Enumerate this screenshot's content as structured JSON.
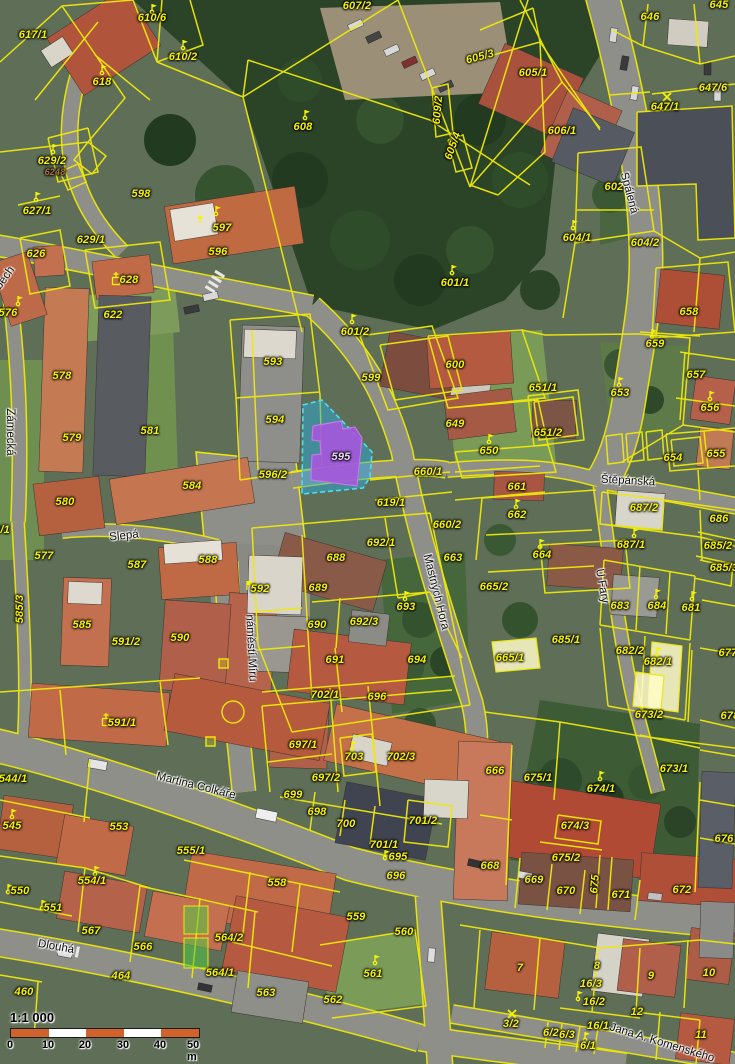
{
  "map": {
    "type": "cadastral-aerial-overlay",
    "highlight_parcel": {
      "number": "595",
      "parcel_fill": "rgba(43,170,220,0.5)",
      "parcel_stroke": "#49e0f2",
      "building_fill": "#a855dd",
      "building_stroke": "#c07ae8"
    },
    "line_color": "#eee90a",
    "scale": {
      "ratio_label": "1:1 000",
      "unit_labels": [
        "0",
        "10",
        "20",
        "30",
        "40",
        "50 m"
      ],
      "tick_positions": [
        0,
        38,
        75,
        113,
        150,
        188
      ],
      "bar_color_a": "#d2622b",
      "bar_color_b": "#ffffff"
    },
    "street_labels": [
      {
        "t": "Spálená",
        "x": 629,
        "y": 193,
        "r": 75
      },
      {
        "t": "Štěpánská",
        "x": 628,
        "y": 481,
        "r": 3
      },
      {
        "t": "Slepá",
        "x": 124,
        "y": 536,
        "r": -6
      },
      {
        "t": "Zámecká",
        "x": 10,
        "y": 432,
        "r": 90
      },
      {
        "t": "náměstí Míru",
        "x": 251,
        "y": 648,
        "r": 87
      },
      {
        "t": "U Fary",
        "x": 602,
        "y": 586,
        "r": 80
      },
      {
        "t": "Mastných Hora",
        "x": 436,
        "y": 592,
        "r": 76
      },
      {
        "t": "Martina Colkáře",
        "x": 196,
        "y": 786,
        "r": 14
      },
      {
        "t": "Dlouhá",
        "x": 56,
        "y": 947,
        "r": 10
      },
      {
        "t": "Jana A. Komenského",
        "x": 662,
        "y": 1043,
        "r": 17
      },
      {
        "t": "bech",
        "x": 5,
        "y": 278,
        "r": -55
      }
    ],
    "parcel_labels": [
      {
        "t": "617/1",
        "x": 33,
        "y": 35
      },
      {
        "t": "610/6",
        "x": 152,
        "y": 18
      },
      {
        "t": "610/2",
        "x": 183,
        "y": 57
      },
      {
        "t": "618",
        "x": 102,
        "y": 82
      },
      {
        "t": "608",
        "x": 303,
        "y": 127
      },
      {
        "t": "607/2",
        "x": 357,
        "y": 6
      },
      {
        "t": "629/2",
        "x": 52,
        "y": 161
      },
      {
        "t": "6248",
        "x": 55,
        "y": 172,
        "cls": "minor"
      },
      {
        "t": "598",
        "x": 141,
        "y": 194
      },
      {
        "t": "596",
        "x": 218,
        "y": 252
      },
      {
        "t": "597",
        "x": 222,
        "y": 228
      },
      {
        "t": "627/1",
        "x": 37,
        "y": 211
      },
      {
        "t": "626",
        "x": 36,
        "y": 254
      },
      {
        "t": "629/1",
        "x": 91,
        "y": 240
      },
      {
        "t": "628",
        "x": 129,
        "y": 280
      },
      {
        "t": "622",
        "x": 113,
        "y": 315
      },
      {
        "t": "576",
        "x": 8,
        "y": 313
      },
      {
        "t": "578",
        "x": 62,
        "y": 376
      },
      {
        "t": "579",
        "x": 72,
        "y": 438
      },
      {
        "t": "581",
        "x": 150,
        "y": 431
      },
      {
        "t": "580",
        "x": 65,
        "y": 502
      },
      {
        "t": "584",
        "x": 192,
        "y": 486
      },
      {
        "t": "8/1",
        "x": 2,
        "y": 530
      },
      {
        "t": "577",
        "x": 44,
        "y": 556
      },
      {
        "t": "587",
        "x": 137,
        "y": 565
      },
      {
        "t": "588",
        "x": 208,
        "y": 560
      },
      {
        "t": "585/3",
        "x": 20,
        "y": 609,
        "r": -90
      },
      {
        "t": "585",
        "x": 82,
        "y": 625
      },
      {
        "t": "591/2",
        "x": 126,
        "y": 642
      },
      {
        "t": "590",
        "x": 180,
        "y": 638
      },
      {
        "t": "593",
        "x": 273,
        "y": 362
      },
      {
        "t": "594",
        "x": 275,
        "y": 420
      },
      {
        "t": "595",
        "x": 341,
        "y": 457,
        "cls": "hl"
      },
      {
        "t": "596/2",
        "x": 273,
        "y": 475
      },
      {
        "t": "599",
        "x": 371,
        "y": 378
      },
      {
        "t": "601/2",
        "x": 355,
        "y": 332
      },
      {
        "t": "601/1",
        "x": 455,
        "y": 283
      },
      {
        "t": "600",
        "x": 455,
        "y": 365
      },
      {
        "t": "605/3",
        "x": 480,
        "y": 57,
        "r": -15
      },
      {
        "t": "605/1",
        "x": 533,
        "y": 73
      },
      {
        "t": "609/2",
        "x": 438,
        "y": 110,
        "r": -85
      },
      {
        "t": "605/4",
        "x": 453,
        "y": 146,
        "r": -70
      },
      {
        "t": "606/1",
        "x": 562,
        "y": 131
      },
      {
        "t": "602",
        "x": 614,
        "y": 187
      },
      {
        "t": "604/1",
        "x": 577,
        "y": 238
      },
      {
        "t": "604/2",
        "x": 645,
        "y": 243
      },
      {
        "t": "646",
        "x": 650,
        "y": 17
      },
      {
        "t": "645",
        "x": 719,
        "y": 5
      },
      {
        "t": "647/6",
        "x": 713,
        "y": 88
      },
      {
        "t": "647/1",
        "x": 665,
        "y": 107
      },
      {
        "t": "658",
        "x": 689,
        "y": 312
      },
      {
        "t": "659",
        "x": 655,
        "y": 344
      },
      {
        "t": "653",
        "x": 620,
        "y": 393
      },
      {
        "t": "651/1",
        "x": 543,
        "y": 388
      },
      {
        "t": "651/2",
        "x": 548,
        "y": 433
      },
      {
        "t": "649",
        "x": 455,
        "y": 424
      },
      {
        "t": "650",
        "x": 489,
        "y": 451
      },
      {
        "t": "657",
        "x": 696,
        "y": 375
      },
      {
        "t": "656",
        "x": 710,
        "y": 408
      },
      {
        "t": "655",
        "x": 716,
        "y": 454
      },
      {
        "t": "654",
        "x": 673,
        "y": 458
      },
      {
        "t": "660/1",
        "x": 428,
        "y": 472
      },
      {
        "t": "619/1",
        "x": 391,
        "y": 503
      },
      {
        "t": "661",
        "x": 517,
        "y": 487
      },
      {
        "t": "662",
        "x": 517,
        "y": 515
      },
      {
        "t": "663",
        "x": 453,
        "y": 558
      },
      {
        "t": "664",
        "x": 542,
        "y": 555
      },
      {
        "t": "665/2",
        "x": 494,
        "y": 587
      },
      {
        "t": "665/1",
        "x": 510,
        "y": 658
      },
      {
        "t": "685/1",
        "x": 566,
        "y": 640
      },
      {
        "t": "687/2",
        "x": 644,
        "y": 508
      },
      {
        "t": "687/1",
        "x": 631,
        "y": 545
      },
      {
        "t": "686",
        "x": 719,
        "y": 519
      },
      {
        "t": "685/2",
        "x": 718,
        "y": 546
      },
      {
        "t": "685/3",
        "x": 724,
        "y": 568
      },
      {
        "t": "683",
        "x": 620,
        "y": 606
      },
      {
        "t": "684",
        "x": 657,
        "y": 606
      },
      {
        "t": "681",
        "x": 691,
        "y": 608
      },
      {
        "t": "682/2",
        "x": 630,
        "y": 651
      },
      {
        "t": "682/1",
        "x": 658,
        "y": 662
      },
      {
        "t": "673/2",
        "x": 649,
        "y": 715
      },
      {
        "t": "677",
        "x": 728,
        "y": 653
      },
      {
        "t": "678",
        "x": 730,
        "y": 716
      },
      {
        "t": "688",
        "x": 336,
        "y": 558
      },
      {
        "t": "689",
        "x": 318,
        "y": 588
      },
      {
        "t": "690",
        "x": 317,
        "y": 625
      },
      {
        "t": "691",
        "x": 335,
        "y": 660
      },
      {
        "t": "692/1",
        "x": 381,
        "y": 543
      },
      {
        "t": "692/3",
        "x": 364,
        "y": 622
      },
      {
        "t": "693",
        "x": 406,
        "y": 607
      },
      {
        "t": "694",
        "x": 417,
        "y": 660
      },
      {
        "t": "695",
        "x": 398,
        "y": 857
      },
      {
        "t": "696",
        "x": 377,
        "y": 697
      },
      {
        "t": "696",
        "x": 396,
        "y": 876
      },
      {
        "t": "702/1",
        "x": 325,
        "y": 695
      },
      {
        "t": "697/1",
        "x": 303,
        "y": 745
      },
      {
        "t": "703",
        "x": 354,
        "y": 757
      },
      {
        "t": "702/3",
        "x": 401,
        "y": 757
      },
      {
        "t": "697/2",
        "x": 326,
        "y": 778
      },
      {
        "t": "699",
        "x": 293,
        "y": 795
      },
      {
        "t": "698",
        "x": 317,
        "y": 812
      },
      {
        "t": "700",
        "x": 346,
        "y": 824
      },
      {
        "t": "701/2",
        "x": 423,
        "y": 821
      },
      {
        "t": "701/1",
        "x": 384,
        "y": 845
      },
      {
        "t": "660/2",
        "x": 447,
        "y": 525
      },
      {
        "t": "592",
        "x": 260,
        "y": 589
      },
      {
        "t": "591/1",
        "x": 122,
        "y": 723
      },
      {
        "t": "544/1",
        "x": 13,
        "y": 779
      },
      {
        "t": "545",
        "x": 12,
        "y": 826
      },
      {
        "t": "553",
        "x": 119,
        "y": 827
      },
      {
        "t": "555/1",
        "x": 191,
        "y": 851
      },
      {
        "t": "550",
        "x": 20,
        "y": 891
      },
      {
        "t": "554/1",
        "x": 92,
        "y": 881
      },
      {
        "t": "551",
        "x": 53,
        "y": 908
      },
      {
        "t": "567",
        "x": 91,
        "y": 931
      },
      {
        "t": "566",
        "x": 143,
        "y": 947
      },
      {
        "t": "564/2",
        "x": 229,
        "y": 938
      },
      {
        "t": "564/1",
        "x": 220,
        "y": 973
      },
      {
        "t": "464",
        "x": 121,
        "y": 976
      },
      {
        "t": "460",
        "x": 24,
        "y": 992
      },
      {
        "t": "558",
        "x": 277,
        "y": 883
      },
      {
        "t": "559",
        "x": 356,
        "y": 917
      },
      {
        "t": "560",
        "x": 404,
        "y": 932
      },
      {
        "t": "561",
        "x": 373,
        "y": 974
      },
      {
        "t": "563",
        "x": 266,
        "y": 993
      },
      {
        "t": "562",
        "x": 333,
        "y": 1000
      },
      {
        "t": "666",
        "x": 495,
        "y": 771
      },
      {
        "t": "675/1",
        "x": 538,
        "y": 778
      },
      {
        "t": "674/1",
        "x": 601,
        "y": 789
      },
      {
        "t": "673/1",
        "x": 674,
        "y": 769
      },
      {
        "t": "674/3",
        "x": 575,
        "y": 826
      },
      {
        "t": "675/2",
        "x": 566,
        "y": 858
      },
      {
        "t": "668",
        "x": 490,
        "y": 866
      },
      {
        "t": "669",
        "x": 534,
        "y": 880
      },
      {
        "t": "670",
        "x": 566,
        "y": 891
      },
      {
        "t": "671",
        "x": 621,
        "y": 895
      },
      {
        "t": "672",
        "x": 682,
        "y": 890
      },
      {
        "t": "675",
        "x": 595,
        "y": 884,
        "r": -85
      },
      {
        "t": "676",
        "x": 724,
        "y": 839
      },
      {
        "t": "7",
        "x": 520,
        "y": 968
      },
      {
        "t": "8",
        "x": 597,
        "y": 966
      },
      {
        "t": "16/3",
        "x": 591,
        "y": 984
      },
      {
        "t": "16/2",
        "x": 594,
        "y": 1002
      },
      {
        "t": "16/1",
        "x": 598,
        "y": 1026
      },
      {
        "t": "9",
        "x": 651,
        "y": 976
      },
      {
        "t": "10",
        "x": 709,
        "y": 973
      },
      {
        "t": "12",
        "x": 637,
        "y": 1012
      },
      {
        "t": "11",
        "x": 701,
        "y": 1035
      },
      {
        "t": "3/2",
        "x": 511,
        "y": 1024
      },
      {
        "t": "6/2",
        "x": 551,
        "y": 1033
      },
      {
        "t": "6/3",
        "x": 567,
        "y": 1035
      },
      {
        "t": "6/1",
        "x": 588,
        "y": 1046
      }
    ],
    "symbols": [
      {
        "k": "flag",
        "x": 152,
        "y": 12
      },
      {
        "k": "flag",
        "x": 183,
        "y": 48
      },
      {
        "k": "flag",
        "x": 102,
        "y": 73
      },
      {
        "k": "flag",
        "x": 53,
        "y": 152
      },
      {
        "k": "flag",
        "x": 305,
        "y": 118
      },
      {
        "k": "flag",
        "x": 36,
        "y": 200
      },
      {
        "k": "flag",
        "x": 18,
        "y": 304
      },
      {
        "k": "cross",
        "x": 200,
        "y": 222
      },
      {
        "k": "flag",
        "x": 216,
        "y": 214
      },
      {
        "k": "csq",
        "x": 116,
        "y": 281
      },
      {
        "k": "flag",
        "x": 452,
        "y": 273
      },
      {
        "k": "flag",
        "x": 352,
        "y": 322
      },
      {
        "k": "flag",
        "x": 573,
        "y": 228
      },
      {
        "k": "flag",
        "x": 619,
        "y": 385
      },
      {
        "k": "flag",
        "x": 652,
        "y": 337
      },
      {
        "k": "flag",
        "x": 489,
        "y": 442
      },
      {
        "k": "flag",
        "x": 540,
        "y": 547
      },
      {
        "k": "flag",
        "x": 516,
        "y": 507
      },
      {
        "k": "flag",
        "x": 634,
        "y": 536
      },
      {
        "k": "flag",
        "x": 656,
        "y": 597
      },
      {
        "k": "flag",
        "x": 692,
        "y": 599
      },
      {
        "k": "flag",
        "x": 657,
        "y": 655
      },
      {
        "k": "flag",
        "x": 405,
        "y": 599
      },
      {
        "k": "flag",
        "x": 385,
        "y": 858
      },
      {
        "k": "fsq",
        "x": 247,
        "y": 588
      },
      {
        "k": "csq",
        "x": 106,
        "y": 722
      },
      {
        "k": "flag",
        "x": 600,
        "y": 779
      },
      {
        "k": "flag",
        "x": 375,
        "y": 963
      },
      {
        "k": "flag",
        "x": 578,
        "y": 999
      },
      {
        "k": "flag",
        "x": 585,
        "y": 1040
      },
      {
        "k": "flag",
        "x": 8,
        "y": 892
      },
      {
        "k": "flag",
        "x": 95,
        "y": 874
      },
      {
        "k": "flag",
        "x": 42,
        "y": 908
      },
      {
        "k": "flag",
        "x": 12,
        "y": 817
      },
      {
        "k": "xmark",
        "x": 512,
        "y": 1014
      },
      {
        "k": "xmark",
        "x": 667,
        "y": 97
      },
      {
        "k": "flag",
        "x": 352,
        "y": 749
      },
      {
        "k": "flag",
        "x": 710,
        "y": 399
      }
    ]
  }
}
